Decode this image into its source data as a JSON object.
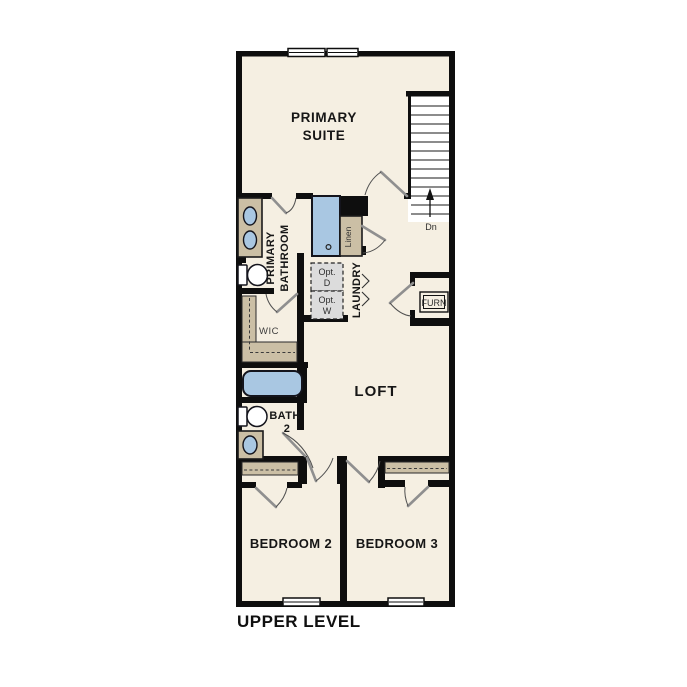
{
  "title": {
    "text": "UPPER LEVEL"
  },
  "labels": {
    "primary_suite_1": "PRIMARY",
    "primary_suite_2": "SUITE",
    "primary_bath_1": "PRIMARY",
    "primary_bath_2": "BATHROOM",
    "linen": "Linen",
    "laundry": "LAUNDRY",
    "opt_dryer_1": "Opt.",
    "opt_dryer_2": "D",
    "opt_washer_1": "Opt.",
    "opt_washer_2": "W",
    "wic": "WIC",
    "furnace": "FURN",
    "loft": "LOFT",
    "bath2_1": "BATH",
    "bath2_2": "2",
    "bedroom2": "BEDROOM 2",
    "bedroom3": "BEDROOM 3",
    "stairs_down": "Dn"
  },
  "colors": {
    "background": "#ffffff",
    "floor": "#f5efe2",
    "wall": "#0e0e0e",
    "cabinet_tan": "#cbbfa5",
    "fixture_blue": "#a9c7e2",
    "appliance_gray": "#dcdcdc"
  }
}
